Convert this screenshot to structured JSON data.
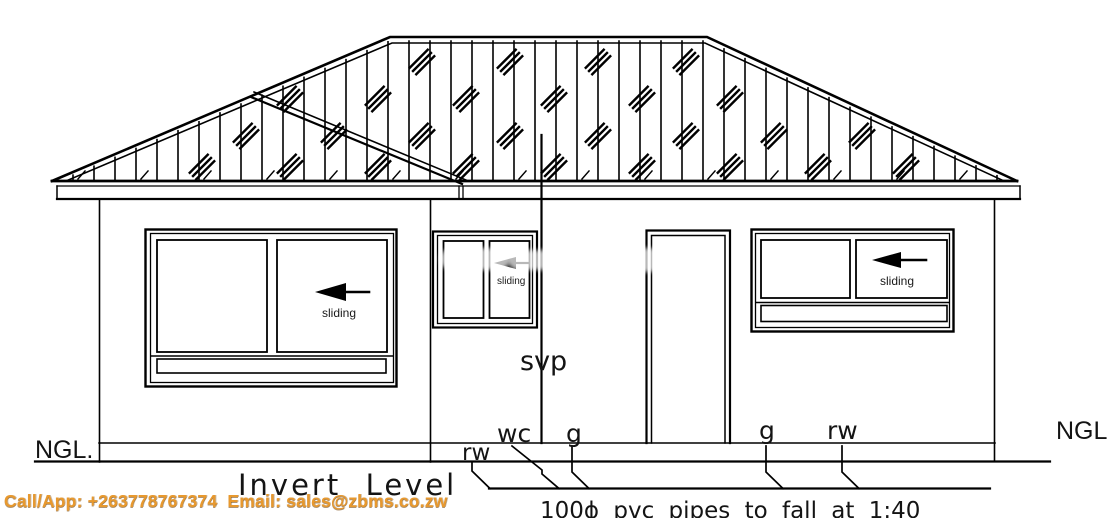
{
  "labels": {
    "ngl_left": "NGL.",
    "ngl_right": "NGL",
    "svp": "svp",
    "wc": "wc",
    "gully_left": "g",
    "gully_right": "g",
    "rainwater_left": "rw",
    "rainwater_right": "rw",
    "invert_level": "Invert  Level",
    "pipe_note": "100ϕ pvc pipes to fall at 1:40",
    "sliding_left_window": "sliding",
    "sliding_middle_window": "sliding",
    "sliding_right_window": "sliding"
  },
  "watermark": {
    "contact": "Call/App: +263778767374  Email: sales@zbms.co.zw",
    "color": "#E8992E"
  },
  "colors": {
    "line": "#000000",
    "background": "#FFFFFF"
  }
}
